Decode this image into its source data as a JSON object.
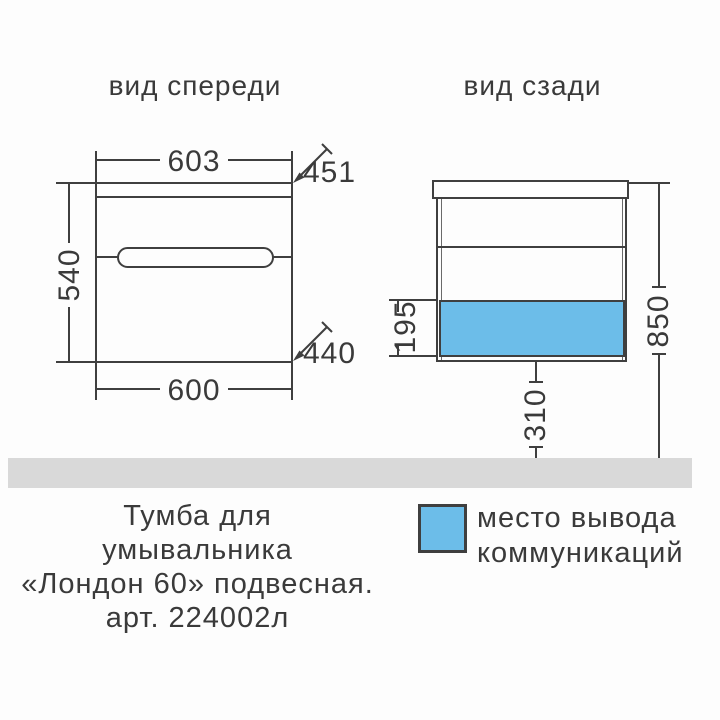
{
  "colors": {
    "line": "#3f3f3f",
    "text": "#3a3a3a",
    "communications_blue": "#6cbde9",
    "floor_gray": "#d9d9d9",
    "background": "#fdfdfd"
  },
  "front_view": {
    "title": "вид спереди",
    "width_top": "603",
    "depth_top": "451",
    "height": "540",
    "depth_bottom": "440",
    "width_bottom": "600"
  },
  "back_view": {
    "title": "вид сзади",
    "outlet_zone_height": "195",
    "total_height": "850",
    "floor_clearance": "310"
  },
  "caption": {
    "lines": [
      "Тумба для",
      "умывальника",
      "«Лондон 60» подвесная.",
      "арт. 224002л"
    ]
  },
  "legend": {
    "swatch_color": "#6cbde9",
    "lines": [
      "место вывода",
      "коммуникаций"
    ]
  }
}
